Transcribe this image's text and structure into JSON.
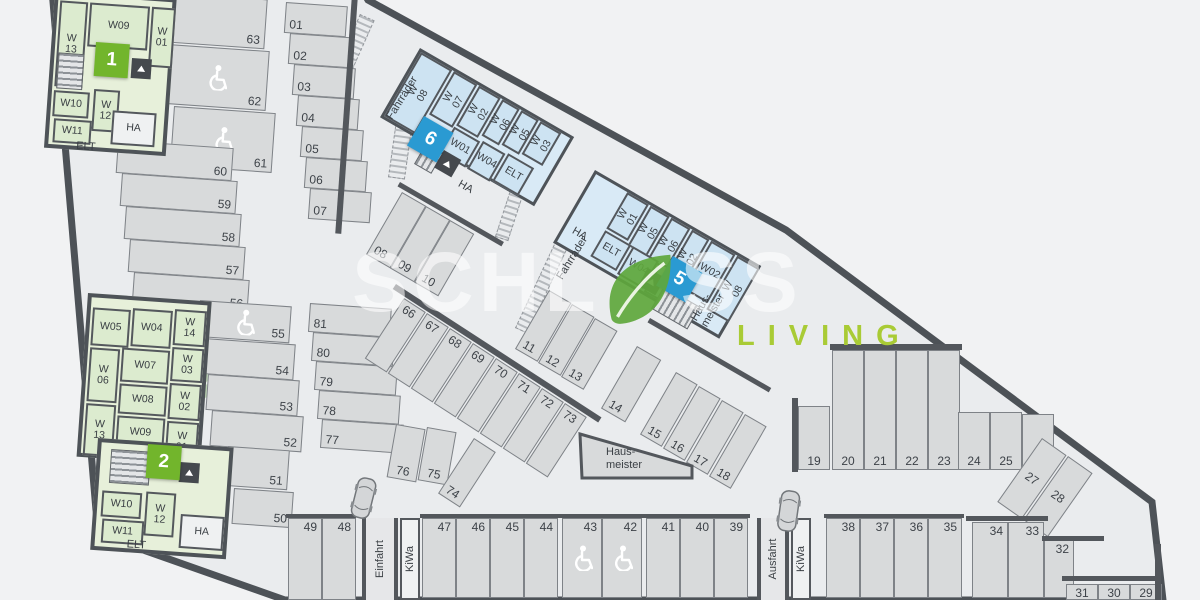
{
  "watermark": {
    "brand_left": "SCHL",
    "brand_right": "SS",
    "tagline": "LIVING"
  },
  "badges": {
    "one": "1",
    "two": "2",
    "five": "5",
    "six": "6"
  },
  "areas": {
    "bike1": "Fahrräder",
    "bike2": "Fahrräder",
    "kiwa1": "KiWa",
    "kiwa2": "KiWa",
    "ramp_in": "Einfahrt",
    "ramp_out": "Ausfahrt",
    "hausmeister": "Haus- meister"
  },
  "rooms": {
    "block_a": {
      "w09": "W09",
      "w13": "W 13",
      "w01": "W 01",
      "w10": "W10",
      "w12": "W 12",
      "w11": "W11",
      "ha": "HA",
      "elt": "ELT"
    },
    "block_b": {
      "w05": "W05",
      "w04": "W04",
      "w14": "W 14",
      "w06": "W 06",
      "w07": "W07",
      "w03": "W 03",
      "w08": "W08",
      "w02": "W 02",
      "w09": "W09",
      "w13": "W 13",
      "w01": "W 01"
    },
    "block_b2": {
      "w10": "W10",
      "w12": "W 12",
      "w11": "W11",
      "ha": "HA",
      "elt": "ELT"
    },
    "block_6": {
      "w08": "W 08",
      "w07": "W 07",
      "w02": "W 02",
      "w06": "W 06",
      "w05": "W 05",
      "w03": "W 03",
      "w01": "W01",
      "w04": "W04",
      "elt": "ELT",
      "ha": "HA"
    },
    "block_5": {
      "w01": "W 01",
      "w05": "W 05",
      "w06": "W 06",
      "w02": "W 02",
      "w02b": "W02",
      "w08": "W 08",
      "elt": "ELT",
      "w04": "W04",
      "w07": "W07",
      "ha": "HA"
    }
  },
  "stalls": {
    "left_top": [
      "63",
      "62",
      "61"
    ],
    "left_col": [
      "60",
      "59",
      "58",
      "57",
      "56"
    ],
    "mid_left": [
      "55",
      "54",
      "53",
      "52"
    ],
    "lower_left": [
      "51",
      "50"
    ],
    "top_col": [
      "01",
      "02",
      "03",
      "04",
      "05",
      "06",
      "07"
    ],
    "diag_a": [
      "08",
      "09",
      "10"
    ],
    "diag_b": [
      "11",
      "12",
      "13"
    ],
    "diag_c": [
      "14",
      "15",
      "16",
      "17",
      "18"
    ],
    "right_row": [
      "19",
      "20",
      "21",
      "22",
      "23",
      "24",
      "25",
      "26"
    ],
    "diag_d": [
      "27",
      "28"
    ],
    "corner": [
      "31",
      "30",
      "29"
    ],
    "bottom_a": [
      "49",
      "48"
    ],
    "bottom_b": [
      "47",
      "46",
      "45",
      "44"
    ],
    "bottom_c": [
      "43",
      "42",
      "41",
      "40",
      "39"
    ],
    "bottom_d": [
      "38",
      "37",
      "36",
      "35"
    ],
    "bottom_e": [
      "34",
      "33"
    ],
    "bottom_f": [
      "32"
    ],
    "island_top": [
      "66",
      "67",
      "68",
      "69",
      "70",
      "71",
      "72",
      "73"
    ],
    "island_low": [
      "76",
      "75",
      "74"
    ],
    "island_col": [
      "81",
      "80",
      "79",
      "78",
      "77"
    ]
  }
}
